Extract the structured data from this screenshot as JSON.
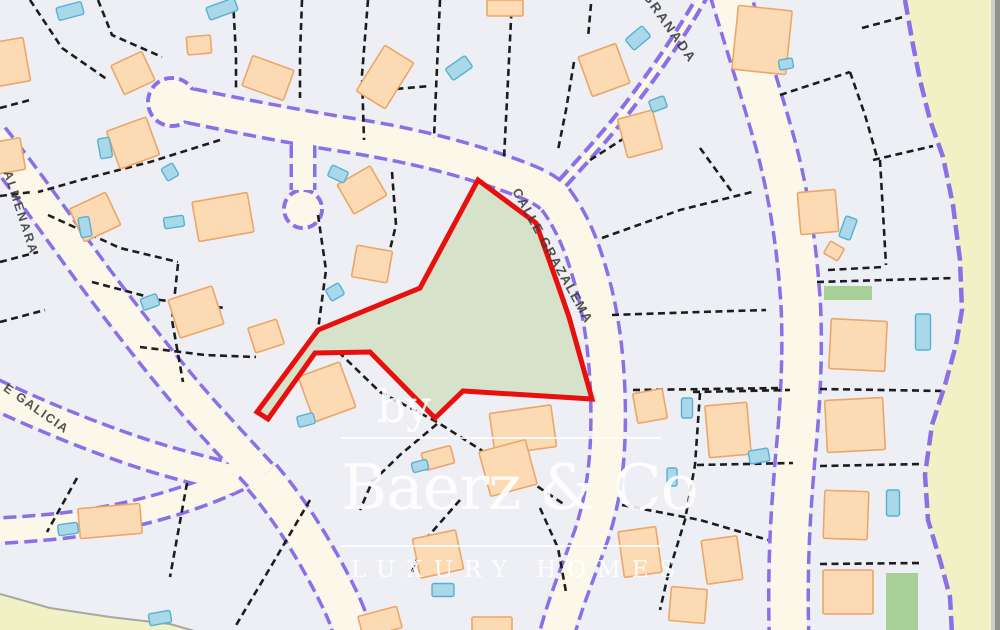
{
  "watermark": {
    "prefix": "by",
    "brand": "Baerz & Co",
    "tagline": "LUXURY HOMES"
  },
  "map": {
    "colors": {
      "background": "#edeff4",
      "road_fill": "#fbf8ea",
      "road_edge": "#8a6fe6",
      "parcel_line": "#1d1d1d",
      "building_fill": "#fcdbb4",
      "building_stroke": "#eca668",
      "pool_fill": "#a9d9e9",
      "pool_stroke": "#57b0d4",
      "garden_fill": "#a9cf98",
      "highlight_fill": "#d6e3ca",
      "highlight_stroke": "#e8100e",
      "outside_fill": "#f0f2c6",
      "boundary_stroke": "#8a6fe6",
      "corner_stroke": "#a8a8a0",
      "edge_strip_light": "#cfcfcd",
      "edge_strip_dark": "#90908e",
      "label_color": "#3a3a3a"
    },
    "street_labels": [
      {
        "id": "granada",
        "text": "GRANADA",
        "x": 666,
        "y": 30,
        "rot": 55,
        "size": 13.5,
        "spacing": 2
      },
      {
        "id": "grazalema",
        "text": "CALLE GRAZALEMA",
        "x": 549,
        "y": 258,
        "rot": 61,
        "size": 13,
        "spacing": 1.5
      },
      {
        "id": "almenara",
        "text": "ALMENARA",
        "x": 17,
        "y": 214,
        "rot": 72,
        "size": 12.5,
        "spacing": 2
      },
      {
        "id": "galicia",
        "text": "E GALICIA",
        "x": 34,
        "y": 412,
        "rot": 35,
        "size": 12.5,
        "spacing": 1.5
      }
    ],
    "roads": [
      {
        "d": "M-8,138 C30,185 70,245 108,295 C140,337 172,378 204,414 C225,437 244,458 262,477",
        "w": 30
      },
      {
        "d": "M262,477 C292,512 318,556 336,592 C345,610 350,622 352,634",
        "w": 34
      },
      {
        "d": "M-8,393 C50,420 100,440 150,456 C178,465 208,472 238,480",
        "w": 26
      },
      {
        "d": "M238,478 C180,505 120,519 60,526 C40,528 15,530 -8,531",
        "w": 22
      },
      {
        "d": "M172,102 C230,114 285,125 335,133 C395,142 445,153 495,170 C525,180 546,188 556,200 C572,222 582,246 591,278 C601,312 607,356 608,401 C609,448 606,492 591,536 C579,570 566,600 557,634",
        "w": 31
      },
      {
        "d": "M303,126 L303,190",
        "w": 20
      },
      {
        "d": "M706,-10 C685,28 660,65 632,102 C605,138 572,172 550,197",
        "w": 5,
        "ew": 13
      },
      {
        "d": "M729,-10 C744,40 762,95 777,150 C790,200 798,255 801,310 C803,360 800,410 795,460 C791,510 787,560 789,634",
        "w": 36
      }
    ],
    "cul_de_sacs": [
      [
        172,
        102,
        24
      ],
      [
        303,
        209,
        19
      ]
    ],
    "parcel_lines": [
      [
        30,
        0,
        62,
        48,
        108,
        80
      ],
      [
        98,
        0,
        112,
        35,
        162,
        57
      ],
      [
        233,
        0,
        236,
        55,
        236,
        88
      ],
      [
        302,
        0,
        300,
        55,
        300,
        98
      ],
      [
        368,
        0,
        362,
        75,
        364,
        140
      ],
      [
        440,
        0,
        436,
        90,
        434,
        138
      ],
      [
        512,
        0,
        507,
        100,
        504,
        158
      ],
      [
        574,
        62,
        566,
        110,
        558,
        150
      ],
      [
        591,
        4,
        588,
        38
      ],
      [
        220,
        140,
        150,
        162,
        88,
        178,
        38,
        192
      ],
      [
        48,
        215,
        120,
        248,
        178,
        262
      ],
      [
        92,
        282,
        160,
        300,
        225,
        308
      ],
      [
        140,
        347,
        205,
        355,
        256,
        357
      ],
      [
        178,
        264,
        172,
        320,
        183,
        382
      ],
      [
        318,
        215,
        326,
        270,
        318,
        330
      ],
      [
        392,
        172,
        396,
        225,
        383,
        278
      ],
      [
        362,
        92,
        430,
        86
      ],
      [
        0,
        108,
        30,
        100
      ],
      [
        0,
        196,
        32,
        192
      ],
      [
        0,
        262,
        38,
        252
      ],
      [
        0,
        322,
        45,
        310
      ],
      [
        322,
        336,
        380,
        392,
        437,
        422,
        525,
        478,
        565,
        505
      ],
      [
        437,
        424,
        400,
        455,
        372,
        482,
        360,
        510
      ],
      [
        700,
        393,
        695,
        465,
        685,
        520,
        668,
        575,
        660,
        610
      ],
      [
        590,
        160,
        637,
        130
      ],
      [
        700,
        148,
        732,
        192
      ],
      [
        602,
        238,
        680,
        210,
        752,
        192
      ],
      [
        612,
        315,
        700,
        312,
        766,
        310
      ],
      [
        633,
        390,
        710,
        389,
        782,
        388
      ],
      [
        693,
        392,
        790,
        390
      ],
      [
        697,
        465,
        793,
        463
      ],
      [
        622,
        505,
        700,
        520,
        768,
        540
      ],
      [
        820,
        389,
        945,
        391
      ],
      [
        820,
        466,
        922,
        464
      ],
      [
        820,
        564,
        922,
        563
      ],
      [
        873,
        160,
        933,
        146
      ],
      [
        780,
        95,
        850,
        72
      ],
      [
        850,
        72,
        865,
        115,
        877,
        157
      ],
      [
        880,
        160,
        886,
        265
      ],
      [
        828,
        270,
        883,
        267
      ],
      [
        817,
        282,
        955,
        278
      ],
      [
        862,
        28,
        903,
        17
      ],
      [
        310,
        500,
        273,
        563,
        235,
        627
      ],
      [
        187,
        483,
        170,
        577
      ],
      [
        77,
        478,
        47,
        532
      ],
      [
        460,
        500,
        425,
        540,
        412,
        572
      ],
      [
        540,
        508,
        558,
        548,
        566,
        592
      ]
    ],
    "buildings": [
      [
        10,
        62,
        34,
        44,
        -10
      ],
      [
        8,
        156,
        30,
        32,
        -10
      ],
      [
        133,
        73,
        34,
        32,
        -25
      ],
      [
        133,
        143,
        42,
        40,
        -20
      ],
      [
        199,
        45,
        24,
        18,
        -5
      ],
      [
        268,
        78,
        44,
        32,
        20
      ],
      [
        385,
        77,
        34,
        54,
        32
      ],
      [
        604,
        70,
        40,
        42,
        -20
      ],
      [
        762,
        40,
        54,
        64,
        6
      ],
      [
        640,
        134,
        36,
        40,
        -15
      ],
      [
        818,
        212,
        38,
        42,
        -5
      ],
      [
        834,
        251,
        16,
        14,
        30
      ],
      [
        223,
        217,
        56,
        40,
        -10
      ],
      [
        95,
        217,
        40,
        36,
        -25
      ],
      [
        196,
        312,
        46,
        40,
        -18
      ],
      [
        266,
        336,
        30,
        26,
        -18
      ],
      [
        372,
        264,
        36,
        32,
        10
      ],
      [
        362,
        190,
        38,
        34,
        -30
      ],
      [
        327,
        392,
        44,
        48,
        -20
      ],
      [
        523,
        430,
        62,
        42,
        -8
      ],
      [
        508,
        468,
        48,
        46,
        -15
      ],
      [
        438,
        458,
        30,
        18,
        -15
      ],
      [
        438,
        554,
        44,
        40,
        -12
      ],
      [
        640,
        552,
        38,
        46,
        -8
      ],
      [
        650,
        406,
        30,
        30,
        -10
      ],
      [
        728,
        430,
        42,
        52,
        -5
      ],
      [
        858,
        345,
        56,
        50,
        3
      ],
      [
        855,
        425,
        58,
        52,
        -3
      ],
      [
        846,
        515,
        44,
        48,
        2
      ],
      [
        848,
        592,
        50,
        44,
        0
      ],
      [
        110,
        521,
        62,
        30,
        -5
      ],
      [
        380,
        622,
        40,
        22,
        -15
      ],
      [
        688,
        605,
        36,
        34,
        5
      ],
      [
        722,
        560,
        36,
        44,
        -8
      ],
      [
        505,
        8,
        36,
        16,
        0
      ],
      [
        492,
        626,
        40,
        18,
        0
      ]
    ],
    "pools": [
      [
        70,
        11,
        26,
        13,
        -15
      ],
      [
        222,
        9,
        30,
        13,
        -20
      ],
      [
        105,
        148,
        12,
        20,
        -10
      ],
      [
        85,
        227,
        11,
        20,
        -10
      ],
      [
        174,
        222,
        20,
        11,
        -8
      ],
      [
        170,
        172,
        13,
        14,
        -30
      ],
      [
        150,
        302,
        17,
        12,
        -20
      ],
      [
        335,
        292,
        15,
        13,
        -30
      ],
      [
        338,
        174,
        18,
        12,
        25
      ],
      [
        306,
        420,
        17,
        11,
        -15
      ],
      [
        68,
        529,
        20,
        11,
        -8
      ],
      [
        160,
        618,
        22,
        12,
        -10
      ],
      [
        443,
        590,
        22,
        13,
        0
      ],
      [
        420,
        466,
        16,
        10,
        -15
      ],
      [
        638,
        38,
        22,
        14,
        -40
      ],
      [
        459,
        68,
        24,
        14,
        -35
      ],
      [
        658,
        104,
        16,
        12,
        -20
      ],
      [
        848,
        228,
        12,
        22,
        20
      ],
      [
        923,
        332,
        15,
        36,
        0
      ],
      [
        893,
        503,
        13,
        26,
        0
      ],
      [
        687,
        408,
        11,
        20,
        0
      ],
      [
        672,
        477,
        10,
        18,
        0
      ],
      [
        759,
        456,
        20,
        13,
        -10
      ],
      [
        786,
        64,
        14,
        10,
        -10
      ]
    ],
    "gardens": [
      [
        824,
        286,
        48,
        14
      ],
      [
        886,
        573,
        32,
        57
      ]
    ],
    "highlighted_parcel": {
      "points": "478,180 536,223 559,288 569,317 592,399 463,391 435,418 370,352 315,353 268,419 257,412 318,330 420,288"
    },
    "boundary_points": [
      905,
      0,
      913,
      45,
      920,
      80,
      930,
      120,
      943,
      157,
      953,
      205,
      960,
      260,
      962,
      310,
      956,
      345,
      945,
      385,
      932,
      425,
      925,
      475,
      928,
      520,
      940,
      560,
      950,
      597,
      952,
      634
    ],
    "corner_points": [
      0,
      594,
      50,
      608,
      110,
      617,
      170,
      624,
      205,
      634
    ]
  }
}
